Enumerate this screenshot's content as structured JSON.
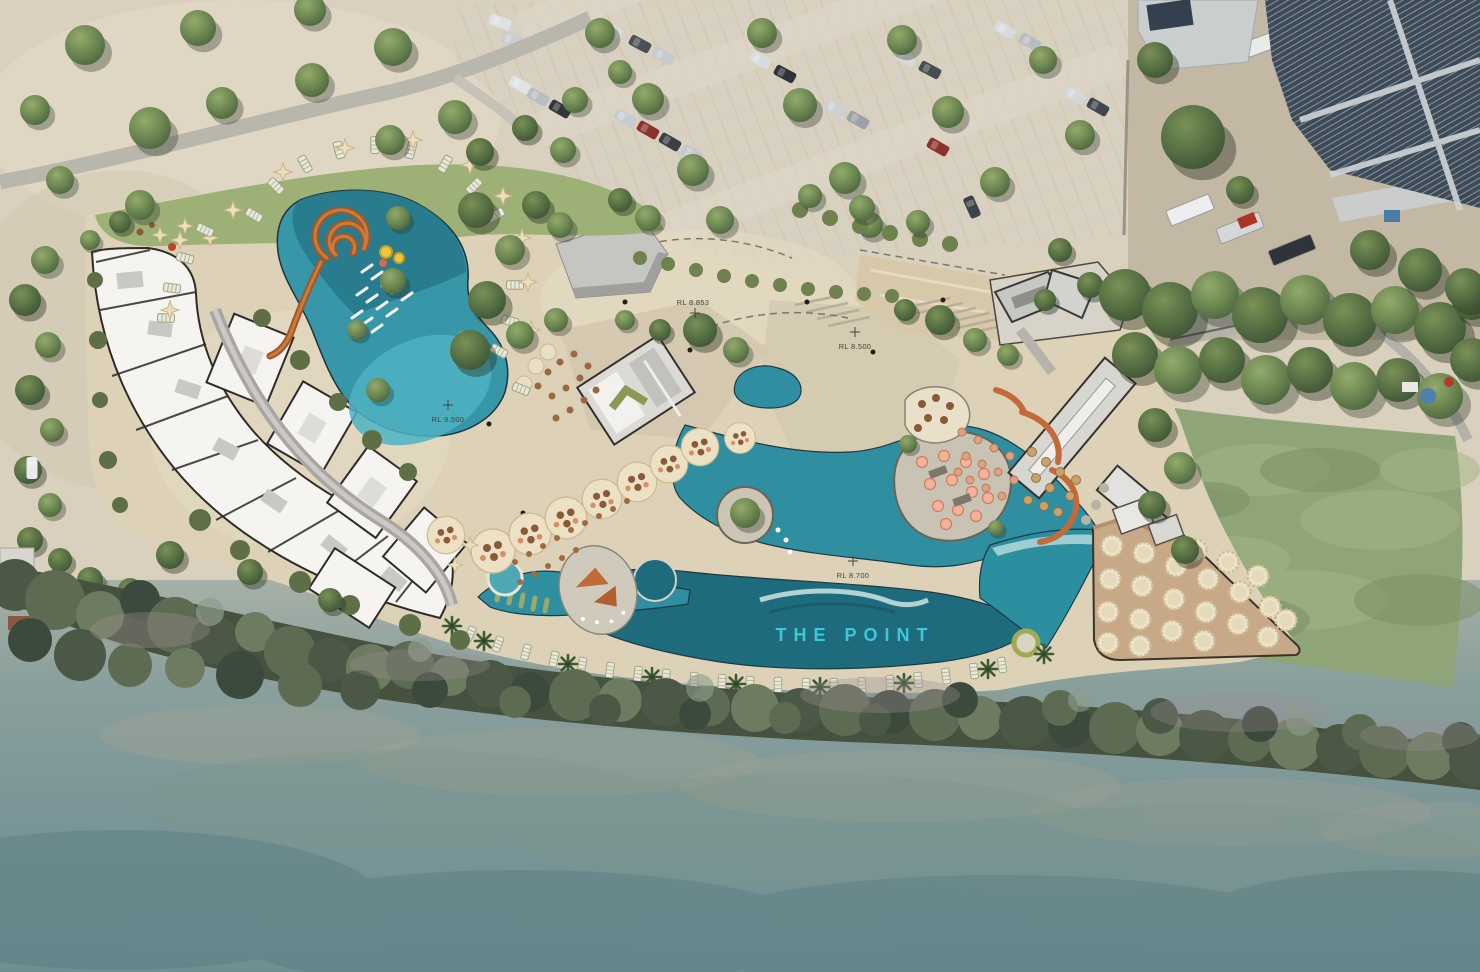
{
  "plan": {
    "site_label": {
      "text": "THE POINT"
    },
    "level_markers": [
      {
        "label": "RL 8.853"
      },
      {
        "label": "RL 8.500"
      },
      {
        "label": "RL 9.500"
      },
      {
        "label": "RL 8.700"
      }
    ],
    "palette": {
      "pool_teal": "#2f8fa0",
      "lagoon_deep": "#1d6b7c",
      "pool_light": "#4fb3c4",
      "hardscape_sand": "#ddd2b8",
      "lawn_green": "#8fa577",
      "mangrove_green": "#46523f",
      "river_water": "#7a9597",
      "deck_timber": "#c8a987",
      "building_white": "#f5f4f0",
      "roof_gray": "#c9c9c7",
      "solar_panel": "#32404f",
      "slide_orange": "#a85a28",
      "label_teal": "#3fc6d8"
    }
  }
}
